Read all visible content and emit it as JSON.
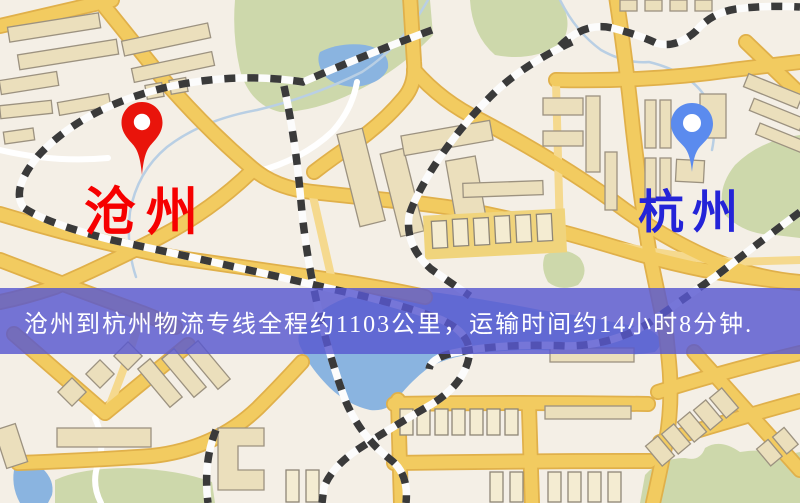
{
  "banner": {
    "text": "沧州到杭州物流专线全程约1103公里，运输时间约14小时8分钟.",
    "background_color": "#5858d0",
    "text_color": "#ffffff"
  },
  "route": {
    "origin": "沧州",
    "destination": "杭州",
    "distance_text": "约1103公里",
    "duration_text": "约14小时8分钟"
  },
  "pins": {
    "origin": {
      "label": "沧州",
      "label_color": "#f60000",
      "pin_color": "#e9140b",
      "icon": "map-pin-icon"
    },
    "destination": {
      "label": "杭州",
      "label_color": "#2424d8",
      "pin_color": "#5b8bee",
      "icon": "map-pin-icon"
    }
  },
  "map_colors": {
    "background": "#f4efe6",
    "road_major": "#f2cb60",
    "road_casing": "#e0b04a",
    "road_minor": "#f5d98e",
    "park_green": "#cdd8ab",
    "water_blue": "#8ab4e0",
    "railway_dark": "#3a3a3a",
    "building_tan": "#ebdfbc"
  }
}
